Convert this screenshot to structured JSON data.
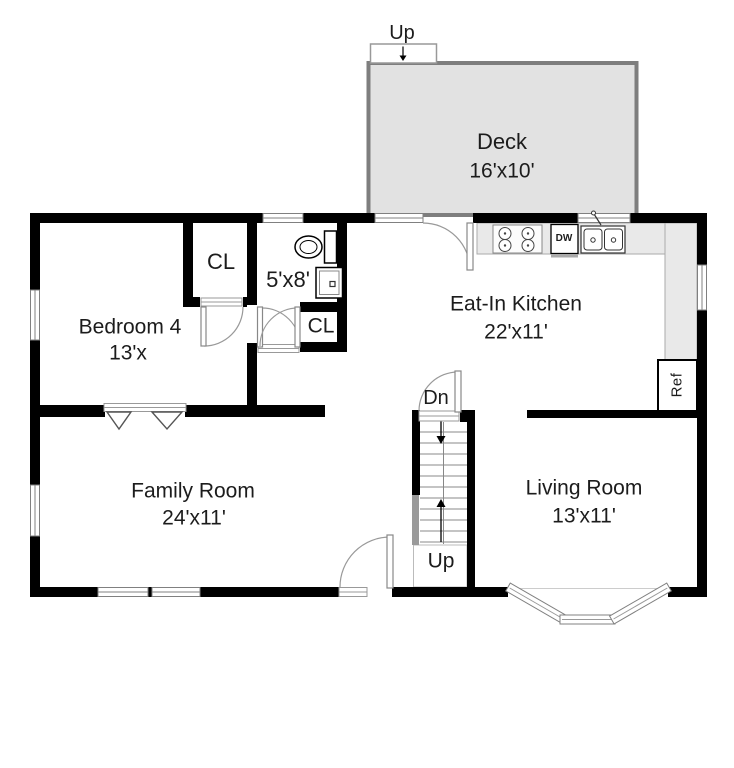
{
  "floorplan": {
    "deck": {
      "up_label": "Up",
      "name": "Deck",
      "dims": "16'x10'"
    },
    "kitchen": {
      "name": "Eat-In Kitchen",
      "dims": "22'x11'"
    },
    "bedroom4": {
      "name": "Bedroom 4",
      "dims": "13'x"
    },
    "bathroom": {
      "dims": "5'x8'"
    },
    "bedroom_closet": {
      "label": "CL"
    },
    "bathroom_closet": {
      "label": "CL"
    },
    "family_room": {
      "name": "Family Room",
      "dims": "24'x11'"
    },
    "living_room": {
      "name": "Living Room",
      "dims": "13'x11'"
    },
    "stairs": {
      "down_label": "Dn",
      "up_label": "Up"
    },
    "appliances": {
      "dishwasher": "DW",
      "refrigerator": "Ref"
    },
    "colors": {
      "wall": "#000000",
      "deck_fill": "#e2e2e2",
      "deck_border": "#7e7e7e",
      "counter_fill": "#e9e9e9",
      "rail": "#9a9a9a"
    }
  }
}
